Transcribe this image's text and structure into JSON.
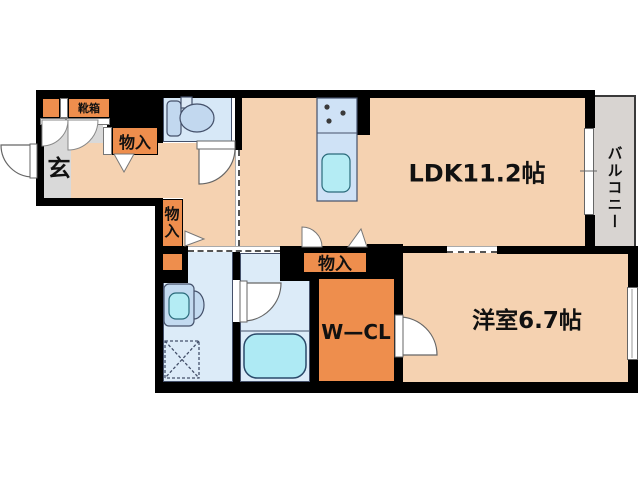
{
  "floorplan": {
    "title": "1LDK apartment floor plan",
    "rooms": {
      "ldk": {
        "label": "LDK11.2帖"
      },
      "western_room": {
        "label": "洋室6.7帖"
      },
      "walk_in_closet": {
        "label": "W—CL"
      },
      "balcony": {
        "label": "バルコニー"
      },
      "entrance": {
        "label": "玄"
      },
      "shoe_box": {
        "label": "靴箱"
      },
      "storage_hall": {
        "label": "物入"
      },
      "storage_corridor": {
        "label": "物入"
      },
      "storage_ldk": {
        "label": "物入"
      }
    },
    "fixtures": [
      "toilet",
      "kitchen-stove",
      "kitchen-sink",
      "vanity-basin",
      "washing-machine-pan",
      "bathtub"
    ],
    "colors": {
      "room_floor_peach": "#f5d2b1",
      "storage_orange": "#ee8e4d",
      "entrance_gray": "#d9d9d9",
      "balcony_gray": "#d8d4d1",
      "wet_area_blue": "#dcebf8",
      "toilet_blue": "#d7e8f7",
      "fixture_blue": "#c3daf0",
      "water_cyan": "#aeeaf4",
      "wall_black": "#000000"
    }
  }
}
